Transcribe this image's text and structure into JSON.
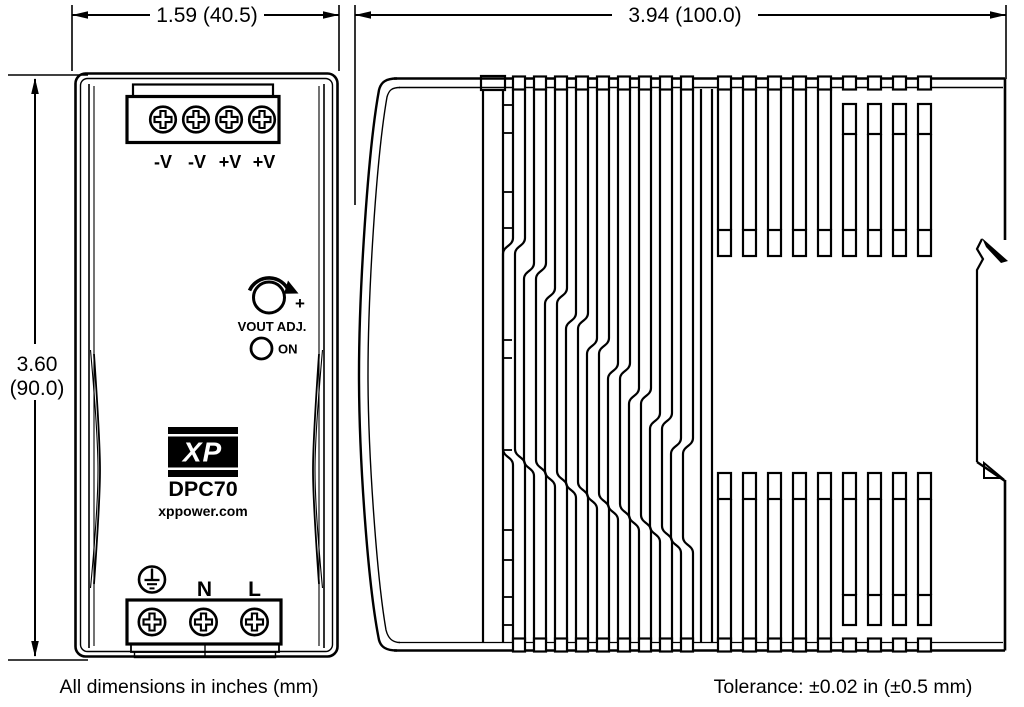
{
  "dimensions": {
    "front_width": "1.59 (40.5)",
    "side_depth": "3.94 (100.0)",
    "height_in": "3.60",
    "height_mm": "(90.0)"
  },
  "front_view": {
    "output_terminals": [
      "-V",
      "-V",
      "+V",
      "+V"
    ],
    "adjust_label": "VOUT ADJ.",
    "adjust_plus": "+",
    "led_label": "ON",
    "logo_text": "XP",
    "model": "DPC70",
    "website": "xppower.com",
    "input_terminals": {
      "neutral": "N",
      "line": "L"
    }
  },
  "notes": {
    "units": "All dimensions in inches (mm)",
    "tolerance": "Tolerance: ±0.02 in (±0.5 mm)"
  },
  "icons": {
    "ground": "earth-ground-icon",
    "screw": "phillips-screw-icon",
    "knob": "potentiometer-knob-icon",
    "led": "power-led-icon"
  },
  "colors": {
    "ink": "#000000",
    "background": "#ffffff"
  }
}
